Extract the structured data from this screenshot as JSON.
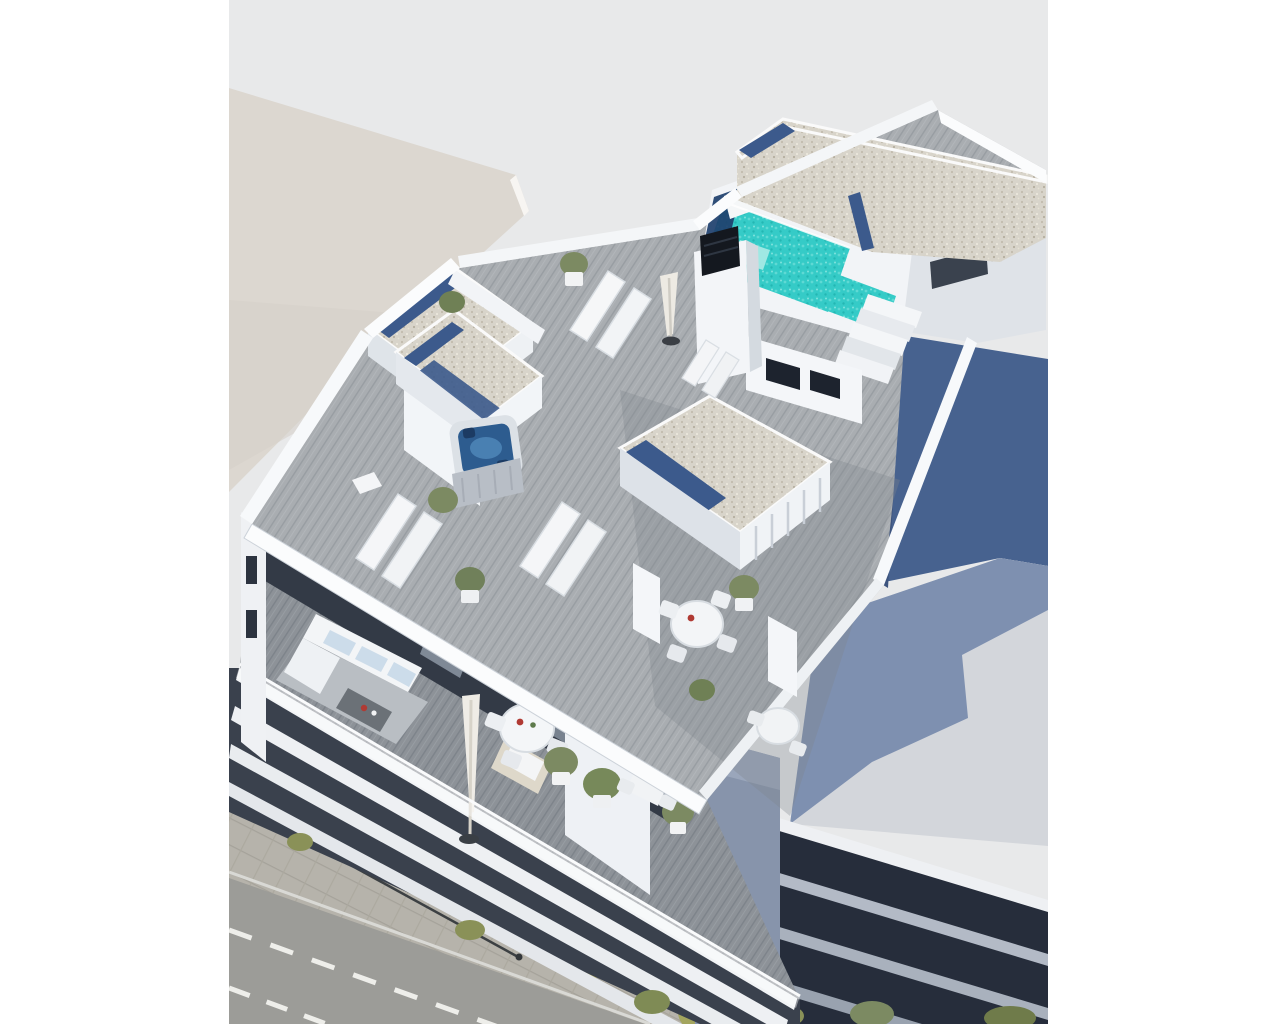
{
  "scene": {
    "title": "Aerial 3D architectural rendering of a modern apartment building",
    "description": "Bird's-eye render of a white residential block with a rooftop terrace: turquoise pool with steps, gravel roof volumes with blue skylights, jacuzzi, sun loungers, round tables, planters; a lower terrace floor with sofa and dining sets; stacked white balcony slabs over a street with sidewalk and small trees; beige neighbour roof upper-left and a dark-blue neighbour building at right with a shadowed flat roof",
    "palette": {
      "page_white": "#ffffff",
      "backdrop_gray": "#e8e9ea",
      "neighbor_roof_beige": "#dcd7d0",
      "wall_white": "#f5f7f9",
      "wall_lit": "#fbfcfd",
      "wall_shadow": "#c9cfd7",
      "interior_dark": "#333a46",
      "deck_wood": "#a9adb1",
      "deck_wood_dark": "#8d9298",
      "gravel": "#d8d4ca",
      "skylight_blue": "#3c5a8c",
      "pool_turquoise": "#35cbc7",
      "pool_deep_navy": "#1e3f6d",
      "pool_step_light": "#9fe8e3",
      "jacuzzi_blue": "#2d5c8f",
      "neighbor_wall_blue": "#47628f",
      "neighbor_roof_gray": "#d3d6db",
      "neighbor_roof_shadow": "#7e90b0",
      "facade_dark": "#262d3b",
      "facade_band_light": "#b3bac6",
      "street_asphalt": "#9c9c98",
      "sidewalk_pavers": "#b6b3ab",
      "lane_marking": "#eeeeea",
      "tree_yellow_green": "#b9b469",
      "tree_green": "#7c8a62",
      "accent_red": "#b03a33",
      "cushion_blue": "#ccdcea"
    },
    "objects": {
      "pool": "L-shaped rooftop swimming pool with corner steps",
      "jacuzzi": "square hot tub with dark blue water",
      "loungers": "four pairs of white sun loungers",
      "tables": "three round white dining sets and two small bistro sets",
      "umbrellas": "two closed white parasols",
      "plants": "potted green shrubs and yellow-green street trees",
      "street": "asphalt road with dashed lane markings and paved sidewalk",
      "neighbors": "beige flat roof at upper left, dark blue slab building at right"
    }
  }
}
